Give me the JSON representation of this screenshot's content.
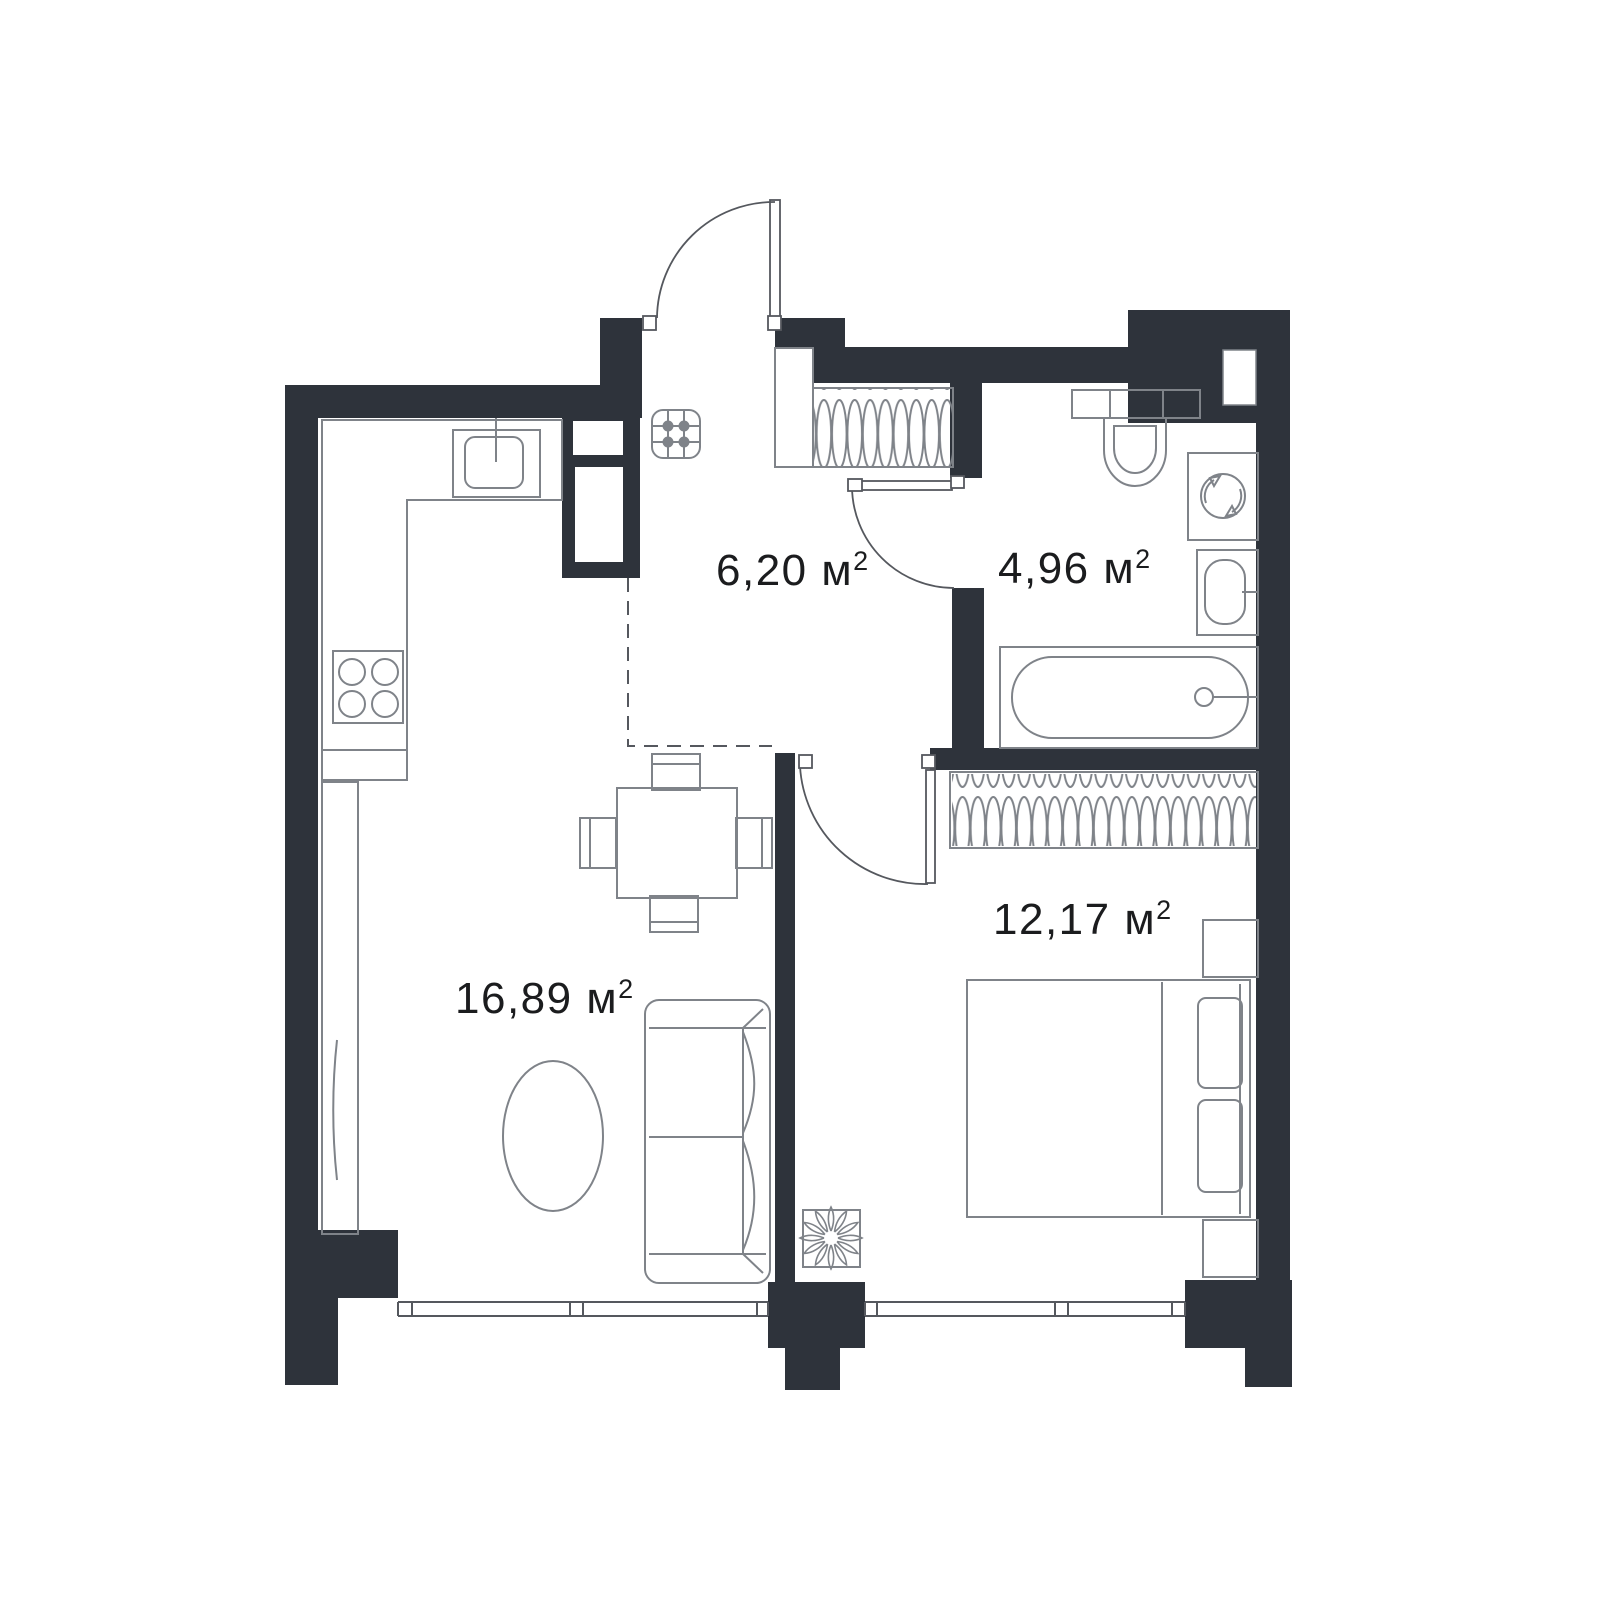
{
  "page": {
    "background": "#ffffff"
  },
  "plan": {
    "name": "apartment-floor-plan",
    "colors": {
      "wall": "#2e333b",
      "furniture_line": "#7f8389",
      "label_text": "#1b1c1e",
      "dashed_line": "#55585e"
    },
    "unit_sup": "2",
    "rooms": [
      {
        "id": "hallway",
        "label": "6,20 м"
      },
      {
        "id": "bathroom",
        "label": "4,96 м"
      },
      {
        "id": "bedroom",
        "label": "12,17 м"
      },
      {
        "id": "living-kitchen",
        "label": "16,89 м"
      }
    ],
    "fixtures": [
      "entrance-door",
      "hallway-wardrobe-hangers",
      "floor-grate-icon",
      "kitchen-counter",
      "kitchen-sink",
      "stove-four-burners",
      "dining-table-four-chairs",
      "tall-cabinet",
      "sofa",
      "coffee-table-oval",
      "toilet",
      "washing-machine-icon",
      "bathroom-sink",
      "bathtub",
      "bedroom-wardrobe-hangers",
      "double-bed",
      "nightstand",
      "plant-icon",
      "window-band"
    ]
  }
}
